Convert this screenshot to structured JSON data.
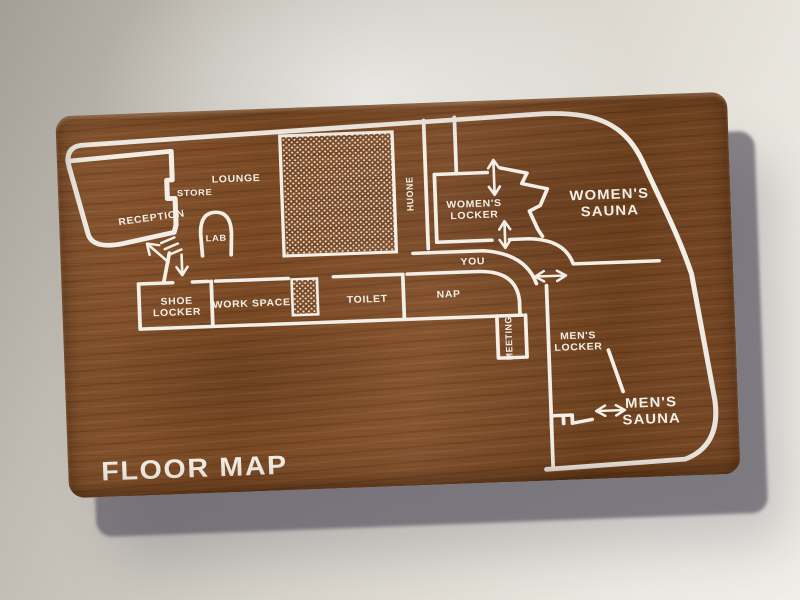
{
  "sign": {
    "title": "FLOOR MAP"
  },
  "rooms": {
    "reception": "RECEPTION",
    "store": "STORE",
    "lounge": "LOUNGE",
    "lab": "LAB",
    "huone": "HUONE",
    "womens_locker_1": "WOMEN'S",
    "womens_locker_2": "LOCKER",
    "womens_sauna_1": "WOMEN'S",
    "womens_sauna_2": "SAUNA",
    "you": "YOU",
    "shoe_locker_1": "SHOE",
    "shoe_locker_2": "LOCKER",
    "work_space": "WORK SPACE",
    "toilet": "TOILET",
    "nap": "NAP",
    "meeting": "MEETING",
    "mens_locker_1": "MEN'S",
    "mens_locker_2": "LOCKER",
    "mens_sauna_1": "MEN'S",
    "mens_sauna_2": "SAUNA"
  },
  "icons": {
    "entrance_stairs": "stairs-up-arrow",
    "entrance_down": "down-arrow",
    "womens_locker_doors": "up-down-arrow",
    "mens_locker_door": "left-right-arrow",
    "mens_sauna_door": "left-right-arrow",
    "womens_sauna_stairs": "step-zigzag"
  },
  "colors": {
    "wood": "#7d4f2a",
    "line": "#f3efe7",
    "wall_bg": "#d8d4cb",
    "shadow": "#5f5c66"
  }
}
